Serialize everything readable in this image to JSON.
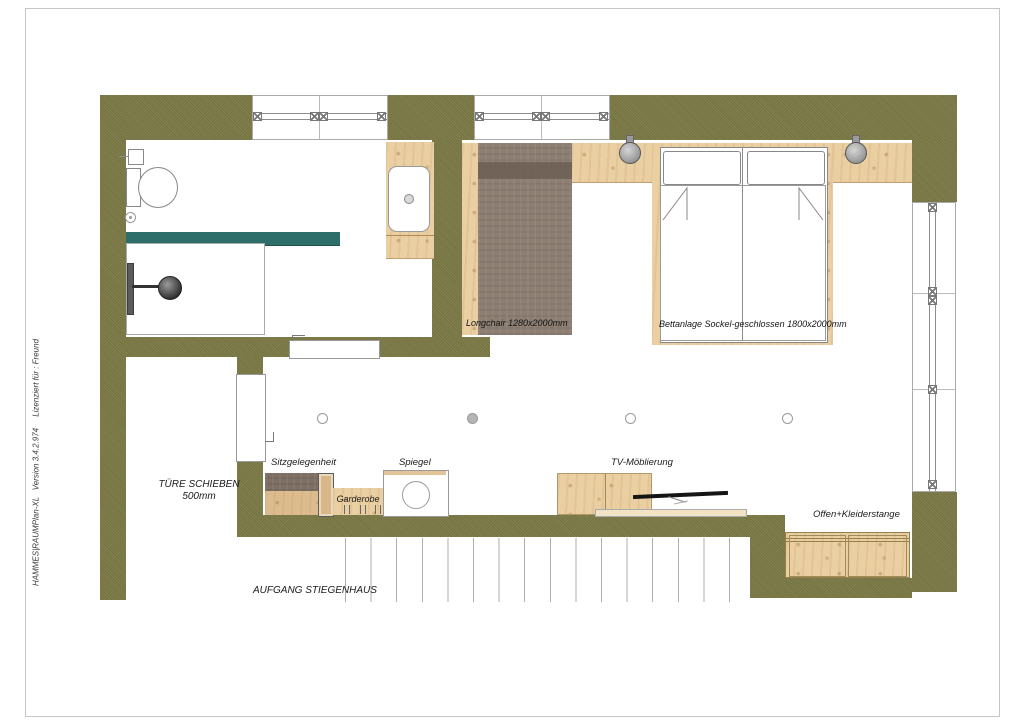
{
  "page": {
    "sidebar_text": "HAMMES|RAUMPlan-XL   Version 3.4.2.974     Lizenziert für : Freund"
  },
  "labels": {
    "longchair": "Longchair 1280x2000mm",
    "bed": "Bettanlage Sockel-geschlossen 1800x2000mm",
    "seat": "Sitzgelegenheit",
    "coat_rack": "Garderobe",
    "mirror": "Spiegel",
    "tv": "TV-Möblierung",
    "open_rail": "Offen+Kleiderstange",
    "door_line1": "TÜRE SCHIEBEN",
    "door_line2": "500mm",
    "stairs": "AUFGANG STIEGENHAUS"
  },
  "colors": {
    "wall_olive": "#7c7a46",
    "glass_teal": "#2e6e6a",
    "wood_light": "#eacfa2",
    "upholstery_brown": "#8d7e72"
  }
}
